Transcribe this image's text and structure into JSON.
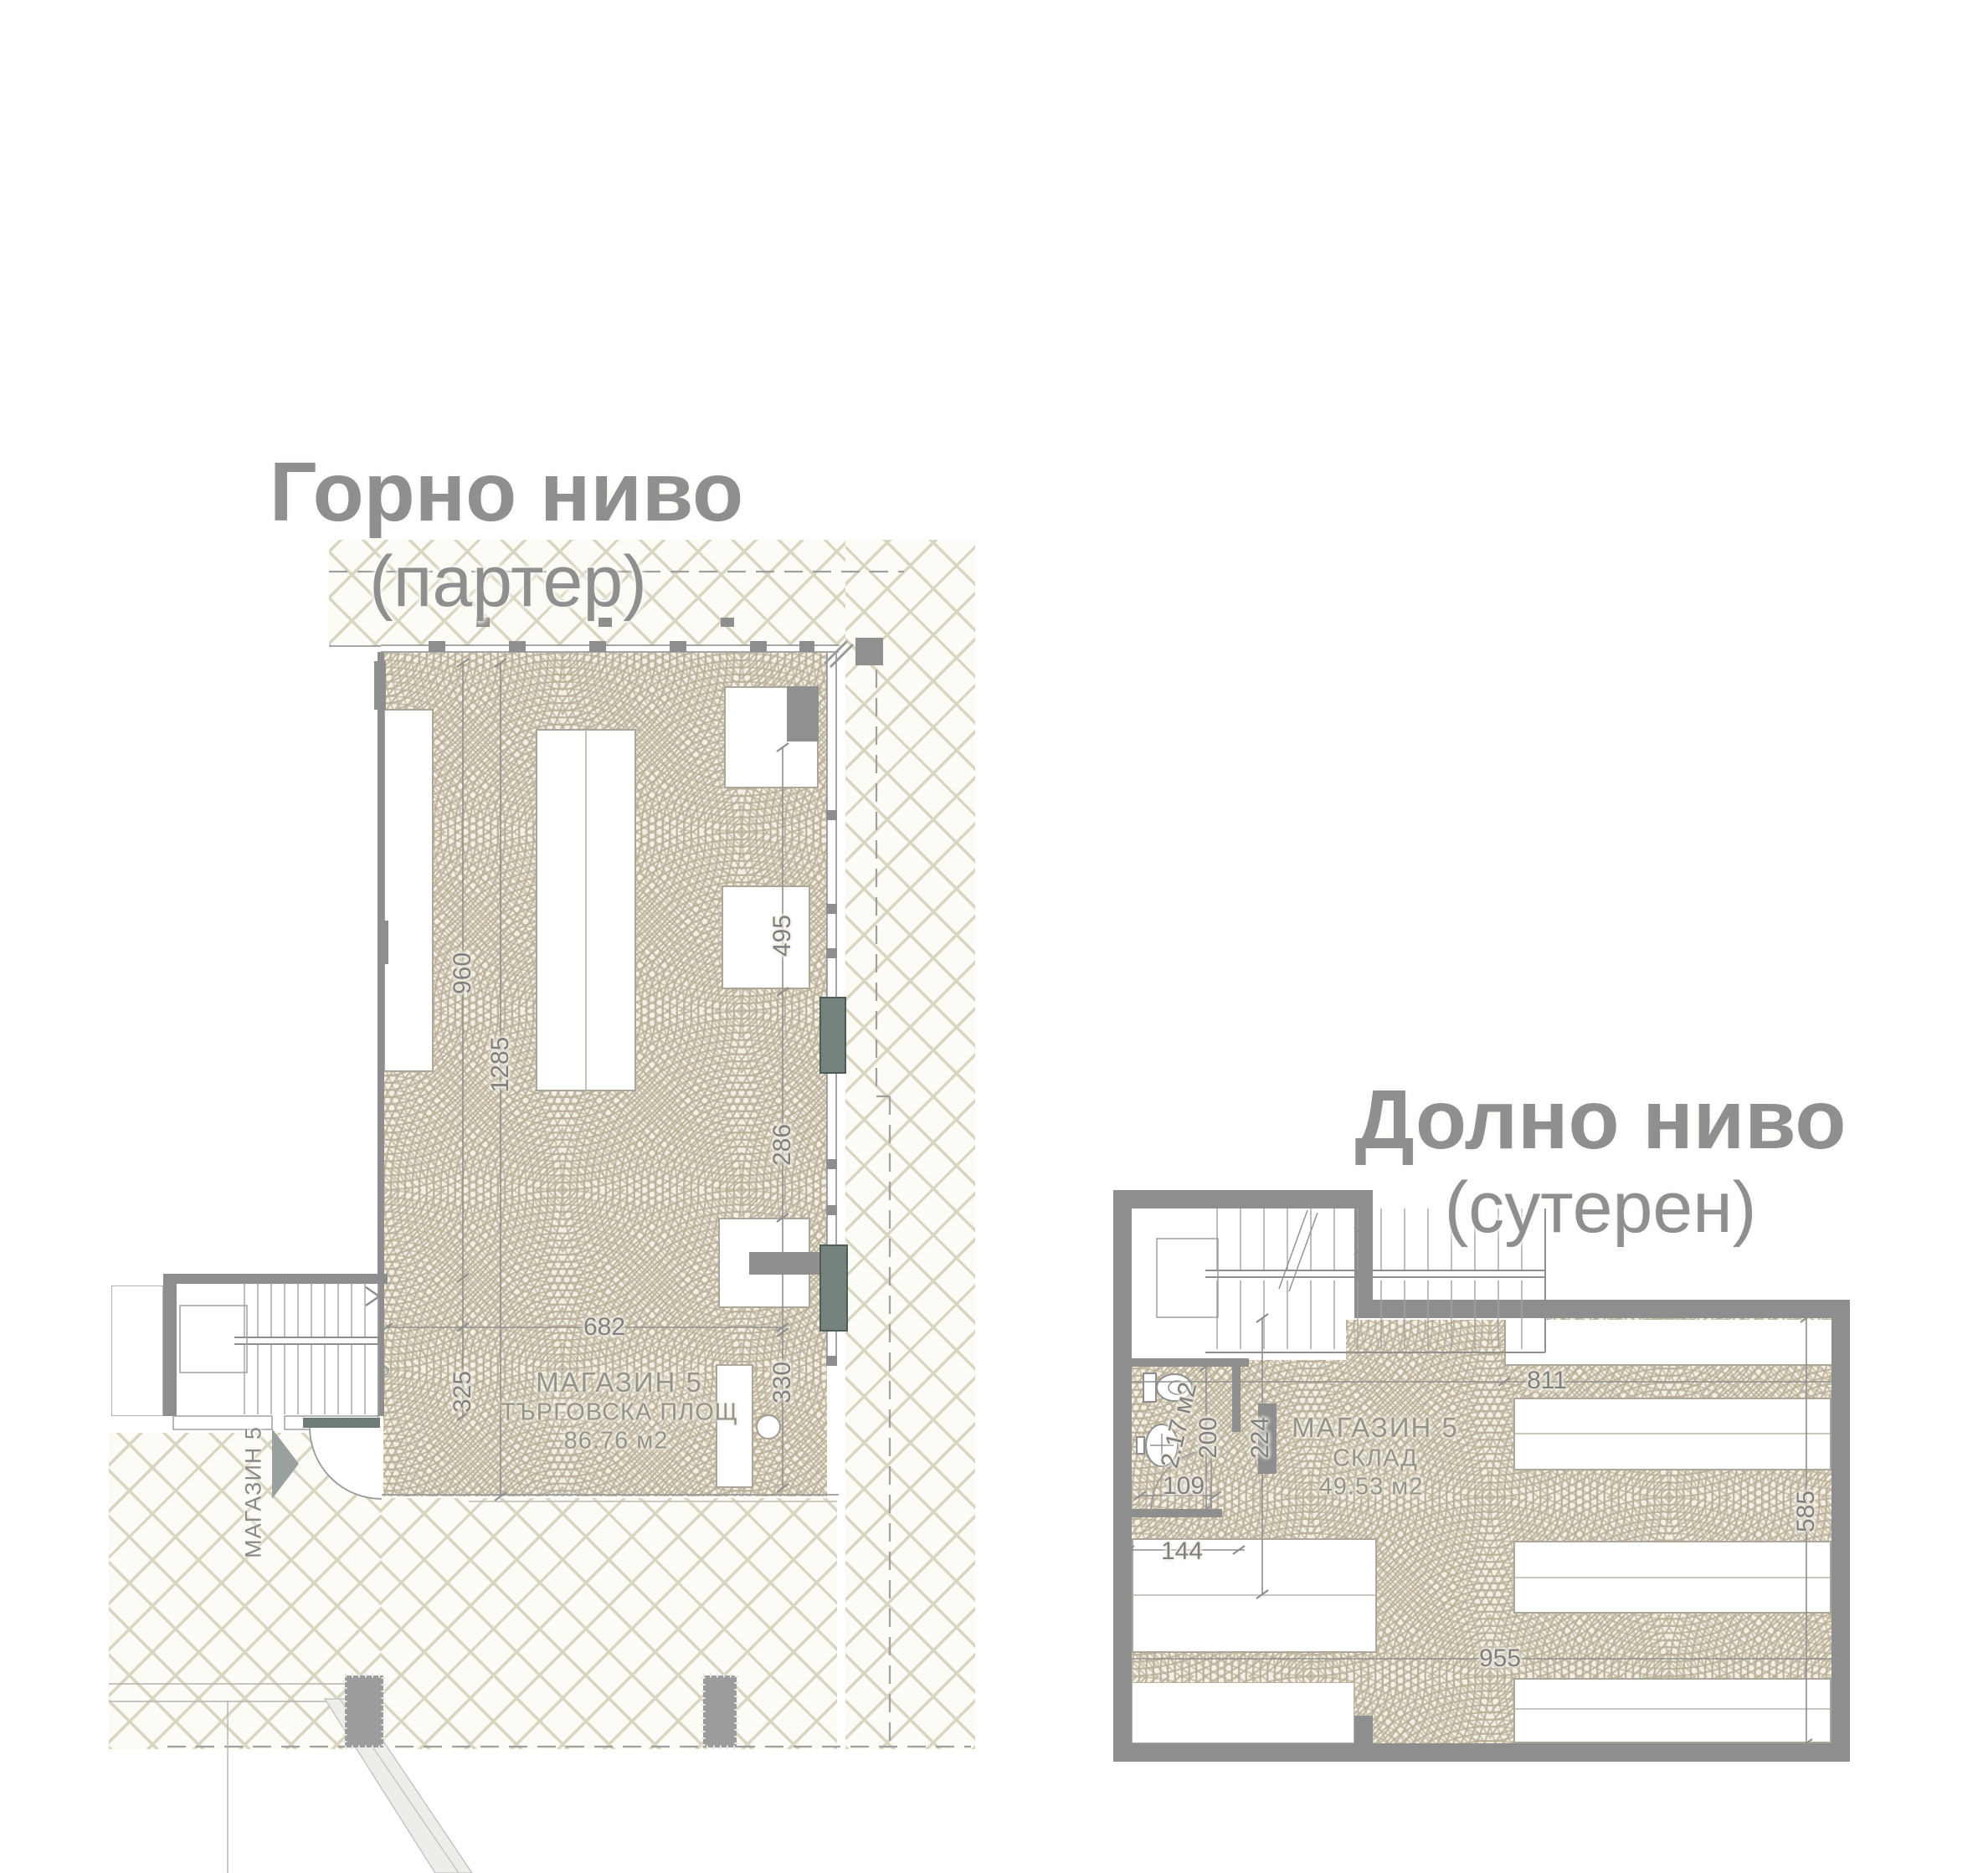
{
  "upper": {
    "title": "Горно ниво",
    "subtitle": "(партер)",
    "room": {
      "name": "МАГАЗИН 5",
      "type": "ТЪРГОВСКА ПЛОЩ",
      "area": "86.76 м2"
    },
    "entrance_label": "МАГАЗИН 5",
    "dims": {
      "depth_left": "960",
      "depth_total": "1285",
      "right_top": "495",
      "right_mid": "286",
      "right_bottom": "330",
      "width_bottom": "682",
      "left_bottom": "325"
    }
  },
  "lower": {
    "title": "Долно ниво",
    "subtitle": "(сутерен)",
    "room": {
      "name": "МАГАЗИН 5",
      "type": "СКЛАД",
      "area": "49.53 м2"
    },
    "wc": {
      "area": "2.17 м2",
      "depth": "200",
      "door_width": "109"
    },
    "dims": {
      "width_top": "811",
      "corridor": "224",
      "shelf": "144",
      "width_bottom": "955",
      "height_right": "585"
    }
  },
  "colors": {
    "wall": "#8e8e8e",
    "fan_hatch": "#b9af98",
    "cross_hatch": "#d9d5c0",
    "door_panel": "#6f7b76",
    "dimension": "#7f7f7f"
  }
}
